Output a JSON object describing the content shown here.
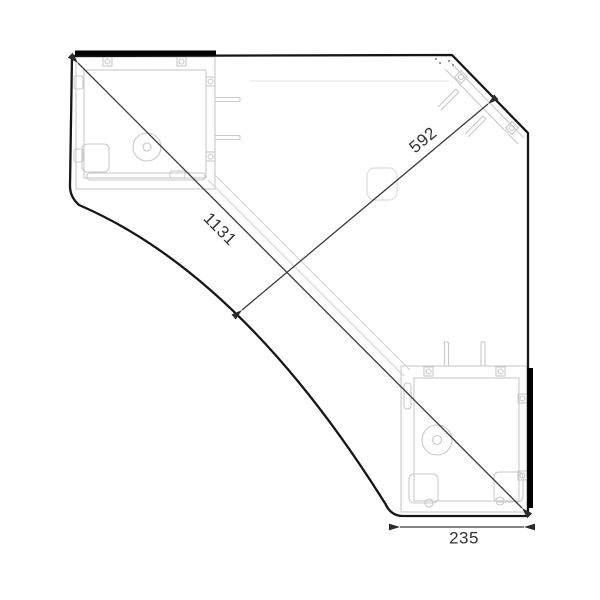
{
  "drawing": {
    "title": "corner-desk-plan-view",
    "colors": {
      "outline": "#161616",
      "panel_highlight": "#000000",
      "detail_gray": "#c9c9c9",
      "faint_gray": "#ececec",
      "dimension": "#3a3a3a",
      "label_text": "#333333",
      "background": "#ffffff"
    },
    "dimensions": {
      "diagonal_long": {
        "label": "1131"
      },
      "diagonal_short": {
        "label": "592"
      },
      "bottom_width": {
        "label": "235"
      }
    }
  }
}
